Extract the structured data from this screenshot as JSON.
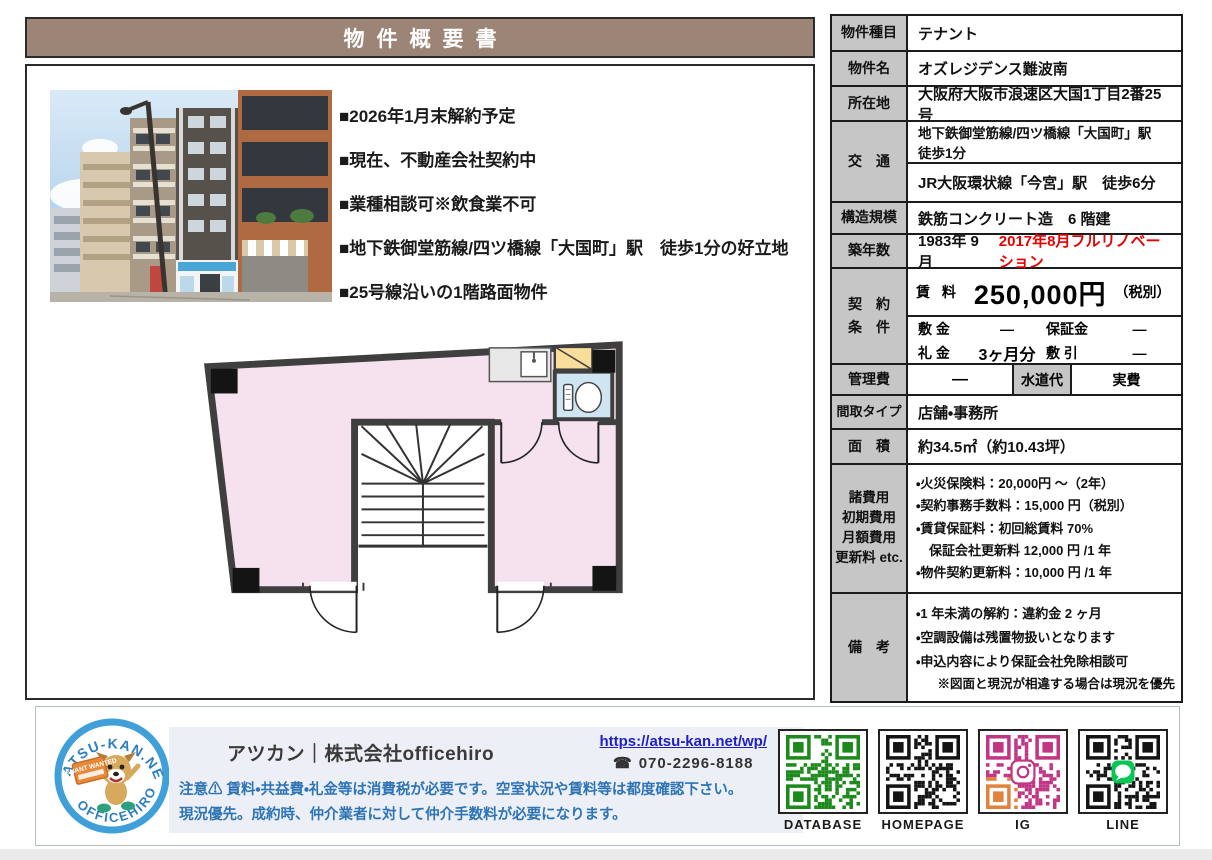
{
  "title": "物件概要書",
  "colors": {
    "title_bg": "#9c8576",
    "label_bg": "#c6c6c6",
    "renovation_red": "#e60000",
    "notice_blue": "#2e74b5",
    "link_blue": "#1f1fc8",
    "floor_pink": "#f6e2ee",
    "toilet_blue": "#cfe6f2",
    "closet_yellow": "#f8dd9b"
  },
  "highlights": [
    "■2026年1月末解約予定",
    "■現在、不動産会社契約中",
    "■業種相談可※飲食業不可",
    "■地下鉄御堂筋線/四ツ橋線「大国町」駅　徒歩1分の好立地",
    "■25号線沿いの1階路面物件"
  ],
  "table": {
    "kind": {
      "label": "物件種目",
      "value": "テナント"
    },
    "name": {
      "label": "物件名",
      "value": "オズレジデンス難波南"
    },
    "address": {
      "label": "所在地",
      "value": "大阪府大阪市浪速区大国1丁目2番25号"
    },
    "access": {
      "label": "交　通",
      "line1": "地下鉄御堂筋線/四ツ橋線「大国町」駅　徒歩1分",
      "line2": "JR大阪環状線「今宮」駅　徒歩6分"
    },
    "structure": {
      "label": "構造規模",
      "value": "鉄筋コンクリート造　6 階建"
    },
    "built": {
      "label": "築年数",
      "value": "1983年 9 月",
      "renovation": "2017年8月フルリノベーション"
    },
    "contract": {
      "label1": "契　約",
      "label2": "条　件",
      "rent_label": "賃 料",
      "rent_value": "250,000円",
      "rent_tax": "（税別）",
      "deposit_label": "敷 金",
      "deposit_value": "—",
      "guarantee_label": "保証金",
      "guarantee_value": "—",
      "key_label": "礼 金",
      "key_value": "3ヶ月分",
      "shikibiki_label": "敷 引",
      "shikibiki_value": "—"
    },
    "mgmt": {
      "label": "管理費",
      "value": "—",
      "water_label": "水道代",
      "water_value": "実費"
    },
    "layout_type": {
      "label": "間取タイプ",
      "value": "店舗・事務所"
    },
    "area": {
      "label": "面　積",
      "value": "約34.5㎡（約10.43坪）"
    },
    "fees": {
      "label_lines": [
        "諸費用",
        "初期費用",
        "月額費用",
        "更新料 etc."
      ],
      "items": [
        "・火災保険料：20,000円 ～（2年）",
        "・契約事務手数料：15,000 円（税別）",
        "・賃貸保証料：初回総賃料 70%",
        "　保証会社更新料 12,000 円 /1 年",
        "・物件契約更新料：10,000 円 /1 年"
      ]
    },
    "notes": {
      "label": "備　考",
      "items": [
        "・1 年未満の解約：違約金 2 ヶ月",
        "・空調設備は残置物扱いとなります",
        "・申込内容により保証会社免除相談可"
      ],
      "footnote": "※図面と現況が相違する場合は現況を優先"
    }
  },
  "footer": {
    "logo": {
      "arc_top": "ATSU-KAN.NET",
      "arc_bottom": "OFFICEHIRO",
      "sign": "TENANT WANTED"
    },
    "company": "アツカン｜株式会社officehiro",
    "url": "https://atsu-kan.net/wp/",
    "phone_icon": "☎",
    "phone": "070-2296-8188",
    "notice1": "注意⚠ 賃料・共益費・礼金等は消費税が必要です。空室状況や賃料等は都度確認下さい。",
    "notice2": "現況優先。成約時、仲介業者に対して仲介手数料が必要になります。",
    "qr": [
      {
        "label": "DATABASE",
        "color": "#1b8a1b",
        "corner_color": "#1b8a1b",
        "center": ""
      },
      {
        "label": "HOMEPAGE",
        "color": "#141414",
        "corner_color": "#141414",
        "center": ""
      },
      {
        "label": "IG",
        "color": "#c13584",
        "corner_color": "#e0833c",
        "center": "ig"
      },
      {
        "label": "LINE",
        "color": "#141414",
        "corner_color": "#141414",
        "center": "line"
      }
    ]
  }
}
